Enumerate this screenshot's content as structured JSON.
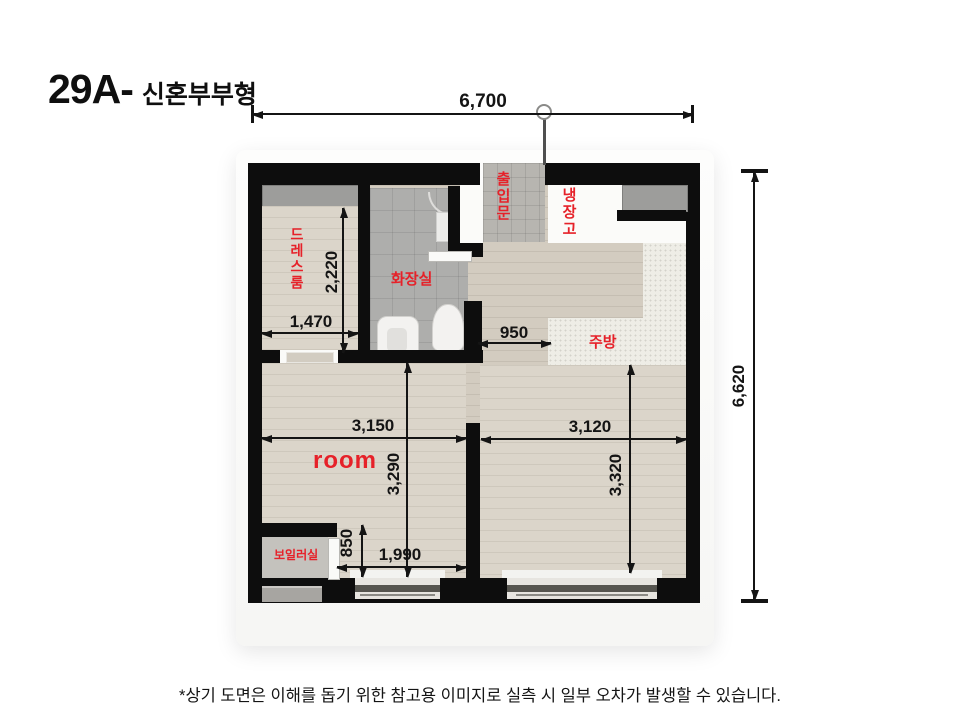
{
  "title": {
    "code": "29A-",
    "subtitle": "신혼부부형"
  },
  "plan": {
    "rooms": {
      "dress": {
        "label": "드레스룸"
      },
      "bath": {
        "label": "화장실"
      },
      "entry": {
        "label": "출입문"
      },
      "fridge": {
        "label": "냉장고"
      },
      "kitchen": {
        "label": "주방"
      },
      "main_room": {
        "label": "room"
      },
      "boiler": {
        "label": "보일러실"
      }
    },
    "dimensions": {
      "overall_width": "6,700",
      "overall_height": "6,620",
      "dress_width": "1,470",
      "dress_depth": "2,220",
      "hall_width": "950",
      "room_width": "3,150",
      "living_width": "3,120",
      "room_depth": "3,290",
      "living_depth": "3,320",
      "boiler_depth": "850",
      "room_lower_width": "1,990"
    }
  },
  "footer": {
    "note": "*상기 도면은 이해를 돕기 위한 참고용 이미지로 실측 시 일부 오차가 발생할 수 있습니다."
  },
  "colors": {
    "wall": "#0d0d0d",
    "label_red": "#e62129",
    "wood": "#d3ccc0",
    "tile": "#aeaeac",
    "counter": "#eeede6",
    "dim_text": "#141414"
  }
}
